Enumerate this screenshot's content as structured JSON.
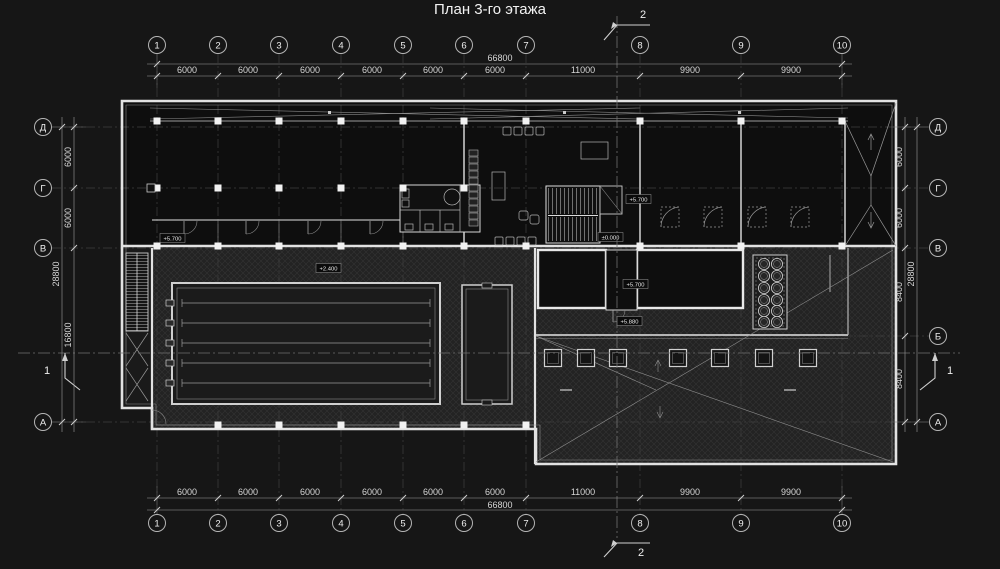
{
  "title": "План 3-го этажа",
  "colors": {
    "background": "#161616",
    "walls": "#e2e2e2",
    "hatch_area": "#2e2e2e",
    "dim_text": "#d6d6d6"
  },
  "axes": {
    "cols": [
      "1",
      "2",
      "3",
      "4",
      "5",
      "6",
      "7",
      "8",
      "9",
      "10"
    ],
    "rows": [
      "Д",
      "Г",
      "В",
      "Б",
      "А"
    ]
  },
  "dims": {
    "top_segments": [
      "6000",
      "6000",
      "6000",
      "6000",
      "6000",
      "6000",
      "11000",
      "9900",
      "9900"
    ],
    "top_total": "66800",
    "bottom_segments": [
      "6000",
      "6000",
      "6000",
      "6000",
      "6000",
      "6000",
      "11000",
      "9900",
      "9900"
    ],
    "bottom_total": "66800",
    "left_segments": [
      "6000",
      "6000",
      "16800"
    ],
    "left_total": "28800",
    "right_segments": [
      "6000",
      "6000",
      "8400",
      "8400"
    ],
    "right_total": "28800"
  },
  "sections": {
    "horizontal": "1",
    "vertical": "2"
  },
  "elevations": {
    "hall": "+5.700",
    "stair_upper": "+5.700",
    "stair_ground": "±0.000",
    "terrace_upper": "+5.700",
    "terrace_lower": "+5.880",
    "pool": "+2.400"
  }
}
